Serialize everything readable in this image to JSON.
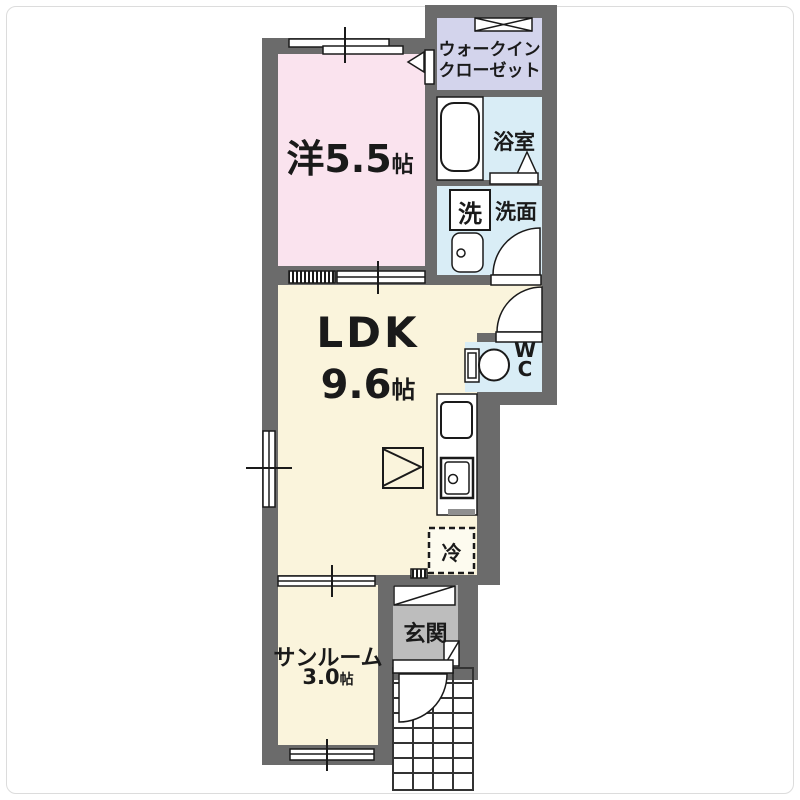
{
  "floor_plan": {
    "rooms": {
      "western": {
        "label": "洋5.5",
        "unit": "帖"
      },
      "walk_in_closet": {
        "line1": "ウォークイン",
        "line2": "クローゼット"
      },
      "bathroom": {
        "label": "浴室"
      },
      "laundry": {
        "label": "洗"
      },
      "washroom": {
        "label": "洗面"
      },
      "ldk": {
        "label": "LDK",
        "size": "9.6",
        "unit": "帖"
      },
      "wc": {
        "line1": "W",
        "line2": "C"
      },
      "refrigerator": {
        "label": "冷"
      },
      "sunroom": {
        "label": "サンルーム",
        "size": "3.0",
        "unit": "帖"
      },
      "entrance": {
        "label": "玄関"
      }
    },
    "colors": {
      "wall": "#6b6b6b",
      "western_room": "#fae3ee",
      "closet": "#d3d4ec",
      "wet_area": "#d9edf6",
      "living_area": "#faf4dc",
      "entrance_floor": "#bdbdbd",
      "fixture_outline": "#1a1a1a",
      "background": "#ffffff"
    }
  }
}
